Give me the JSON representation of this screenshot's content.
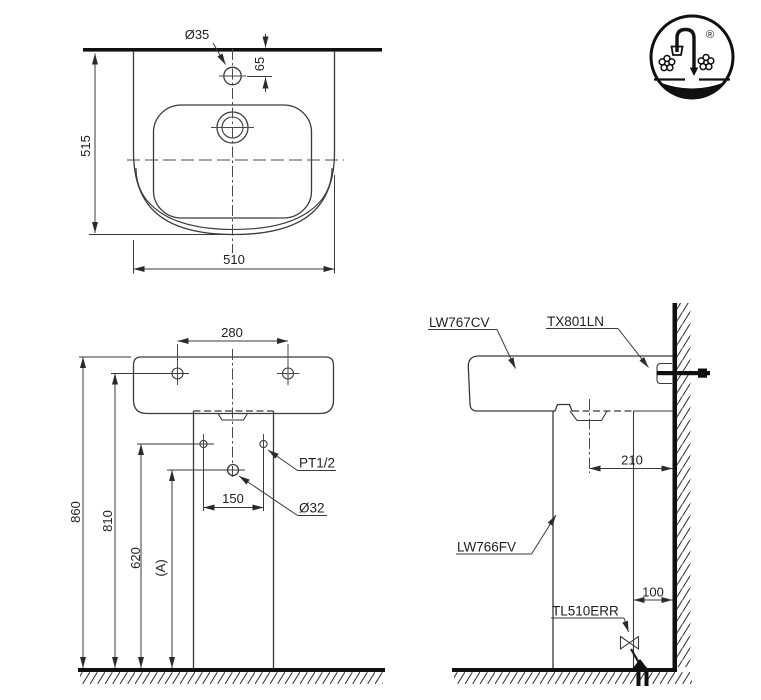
{
  "logo": {
    "registered_mark": "®"
  },
  "top_view": {
    "dim_faucet_hole": "Ø35",
    "dim_hole_to_wall": "65",
    "dim_depth": "515",
    "dim_width": "510"
  },
  "front_view": {
    "dim_hole_spacing": "280",
    "dim_total_height": "860",
    "dim_mount_hole_height": "810",
    "dim_supply_height": "620",
    "dim_drain_height": "(A)",
    "dim_supply_spacing": "150",
    "label_supply_thread": "PT1/2",
    "label_drain_diameter": "Ø32"
  },
  "side_view": {
    "label_lavatory": "LW767CV",
    "label_faucet": "TX801LN",
    "label_pedestal": "LW766FV",
    "label_drain_valve": "TL510ERR",
    "dim_drain_to_wall": "210",
    "dim_outlet_to_wall": "100"
  },
  "colors": {
    "line": "#3a3a3a",
    "thick_line": "#101010",
    "text": "#1f1f1f",
    "background": "#ffffff"
  }
}
